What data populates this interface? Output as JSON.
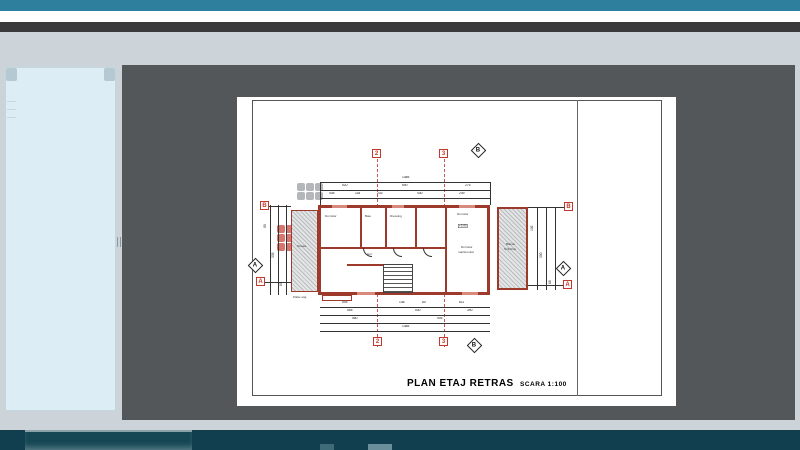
{
  "window": {
    "accent_color": "#2e7e9e",
    "chrome_dark_color": "#39393b",
    "background_color": "#ccd4d9",
    "canvas_color": "#54575a",
    "taskbar_color": "#113f4f"
  },
  "sidebar": {
    "background_color": "#dcedf5"
  },
  "document": {
    "title": "PLAN ETAJ RETRAS",
    "scale_label": "SCARA 1:100",
    "watermark": {
      "text": "Commerciale"
    },
    "wall_color": "#9e3a2b",
    "marker_color": "#c0392b",
    "grid_markers": [
      {
        "label": "2",
        "shape": "box",
        "x": 135,
        "y": 52
      },
      {
        "label": "3",
        "shape": "box",
        "x": 202,
        "y": 52
      },
      {
        "label": "B",
        "shape": "diamond",
        "x": 236,
        "y": 48
      },
      {
        "label": "B",
        "shape": "box",
        "x": 23,
        "y": 104
      },
      {
        "label": "A",
        "shape": "diamond",
        "x": 13,
        "y": 163
      },
      {
        "label": "A",
        "shape": "box",
        "x": 19,
        "y": 180
      },
      {
        "label": "B",
        "shape": "box",
        "x": 327,
        "y": 105
      },
      {
        "label": "A",
        "shape": "diamond",
        "x": 321,
        "y": 166
      },
      {
        "label": "A",
        "shape": "box",
        "x": 326,
        "y": 183
      },
      {
        "label": "2",
        "shape": "box",
        "x": 136,
        "y": 240
      },
      {
        "label": "3",
        "shape": "box",
        "x": 202,
        "y": 240
      },
      {
        "label": "B",
        "shape": "diamond",
        "x": 232,
        "y": 243
      }
    ],
    "dim_labels": [
      {
        "t": "1485",
        "x": 165,
        "y": 79
      },
      {
        "t": "520",
        "x": 105,
        "y": 87
      },
      {
        "t": "690",
        "x": 165,
        "y": 87
      },
      {
        "t": "275",
        "x": 228,
        "y": 87
      },
      {
        "t": "445",
        "x": 92,
        "y": 95
      },
      {
        "t": "118",
        "x": 118,
        "y": 95
      },
      {
        "t": "233",
        "x": 140,
        "y": 95
      },
      {
        "t": "440",
        "x": 180,
        "y": 95
      },
      {
        "t": "249",
        "x": 222,
        "y": 95
      },
      {
        "t": "505",
        "x": 105,
        "y": 204
      },
      {
        "t": "148",
        "x": 162,
        "y": 204
      },
      {
        "t": "80",
        "x": 185,
        "y": 204
      },
      {
        "t": "611",
        "x": 222,
        "y": 204
      },
      {
        "t": "555",
        "x": 110,
        "y": 212
      },
      {
        "t": "540",
        "x": 178,
        "y": 212
      },
      {
        "t": "390",
        "x": 230,
        "y": 212
      },
      {
        "t": "580",
        "x": 115,
        "y": 220
      },
      {
        "t": "905",
        "x": 200,
        "y": 220
      },
      {
        "t": "1485",
        "x": 165,
        "y": 228
      },
      {
        "t": "95",
        "x": 30,
        "y": 125,
        "rot": true
      },
      {
        "t": "335",
        "x": 38,
        "y": 155,
        "rot": true
      },
      {
        "t": "80",
        "x": 46,
        "y": 183,
        "rot": true
      },
      {
        "t": "102",
        "x": 297,
        "y": 128,
        "rot": true
      },
      {
        "t": "300",
        "x": 306,
        "y": 155,
        "rot": true
      },
      {
        "t": "88",
        "x": 315,
        "y": 181,
        "rot": true
      }
    ],
    "room_labels": [
      {
        "t": "Dormitor",
        "x": 88,
        "y": 118
      },
      {
        "t": "Baie",
        "x": 128,
        "y": 118
      },
      {
        "t": "Dressing",
        "x": 153,
        "y": 118
      },
      {
        "t": "Dormitor",
        "x": 220,
        "y": 116
      },
      {
        "t": "+5.80",
        "x": 221,
        "y": 127,
        "boxed": true
      },
      {
        "t": "Dormitor",
        "x": 224,
        "y": 149
      },
      {
        "t": "matrimonial",
        "x": 221,
        "y": 154
      },
      {
        "t": "Hol",
        "x": 130,
        "y": 156
      },
      {
        "t": "Terasa",
        "x": 60,
        "y": 148
      },
      {
        "t": "Balcon",
        "x": 269,
        "y": 146
      },
      {
        "t": "S=9.0mp",
        "x": 267,
        "y": 151
      },
      {
        "t": "Palier etaj",
        "x": 56,
        "y": 199
      }
    ]
  }
}
